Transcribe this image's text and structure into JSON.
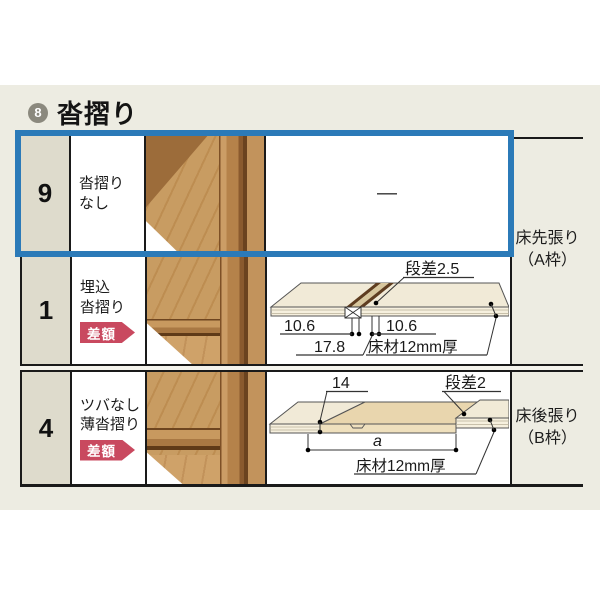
{
  "header": {
    "index_number": "8",
    "title": "沓摺り"
  },
  "colors": {
    "panel_bg": "#edece2",
    "highlight_border": "#2b7ab8",
    "badge_red": "#c9495f",
    "table_line": "#1a1a1a",
    "number_cell_bg": "#dedbcc"
  },
  "rows": [
    {
      "number": "9",
      "name_line1": "沓摺り",
      "name_line2": "なし",
      "badge": "",
      "diagram_dash": "—",
      "selected": true
    },
    {
      "number": "1",
      "name_line1": "埋込",
      "name_line2": "沓摺り",
      "badge": "差額",
      "diagram": {
        "step": "段差2.5",
        "dim_left": "10.6",
        "dim_right": "10.6",
        "dim_total": "17.8",
        "material": "床材12mm厚"
      }
    },
    {
      "number": "4",
      "name_line1": "ツバなし",
      "name_line2": "薄沓摺り",
      "badge": "差額",
      "diagram": {
        "dim_overlap": "14",
        "step": "段差2",
        "dim_span": "a",
        "material": "床材12mm厚"
      }
    }
  ],
  "frame_labels": [
    {
      "line1": "床先張り",
      "line2": "（A枠）"
    },
    {
      "line1": "床後張り",
      "line2": "（B枠）"
    }
  ]
}
